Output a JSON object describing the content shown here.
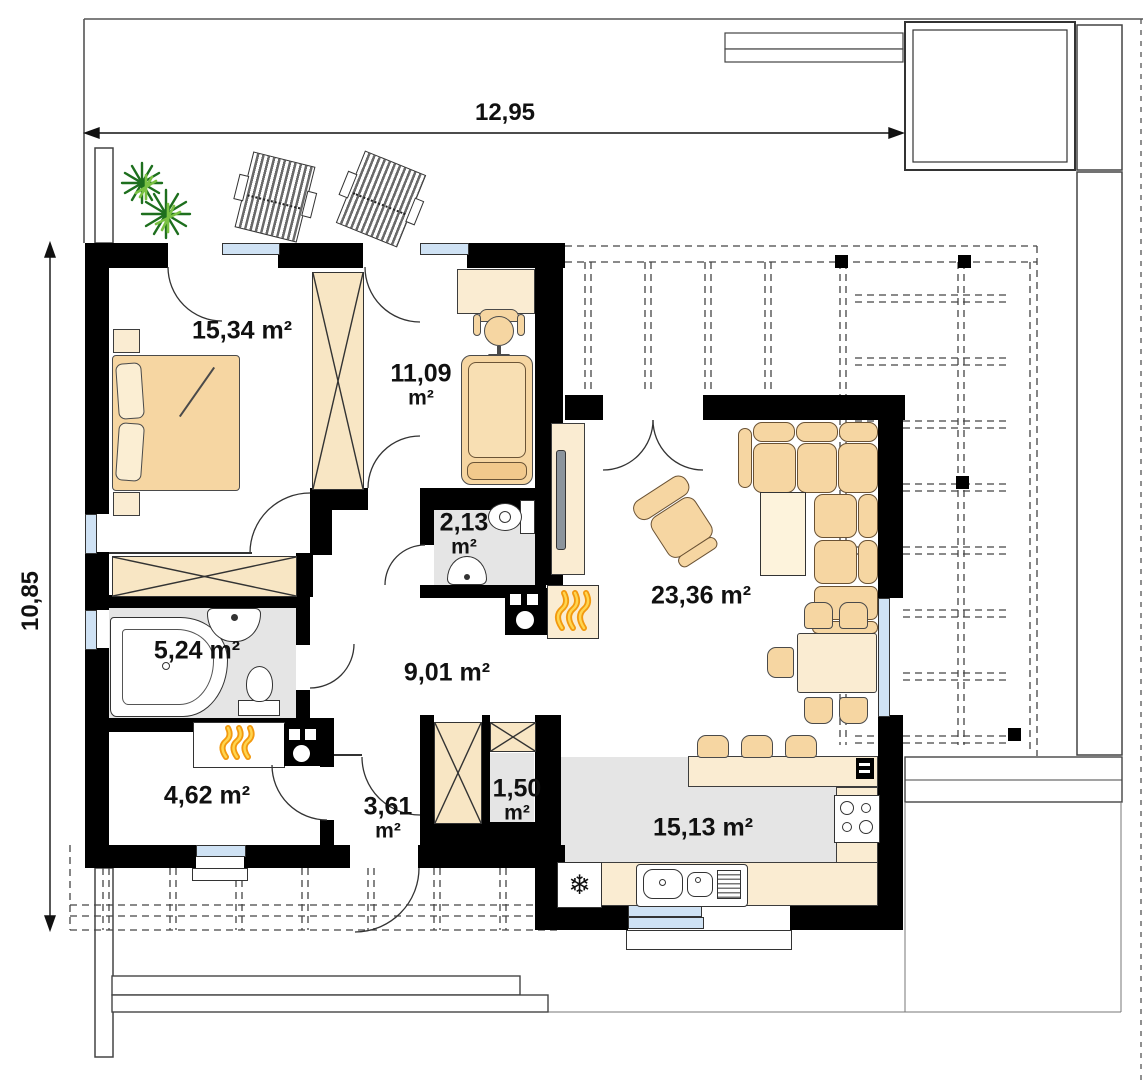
{
  "dimensions": {
    "top": "12,95",
    "left": "10,85"
  },
  "rooms": {
    "bedroom": {
      "area": "15,34 m²"
    },
    "office": {
      "value": "11,09",
      "unit": "m²"
    },
    "wc": {
      "value": "2,13",
      "unit": "m²"
    },
    "bathroom": {
      "area": "5,24 m²"
    },
    "boiler": {
      "area": "4,62 m²"
    },
    "entry": {
      "value": "3,61",
      "unit": "m²"
    },
    "pantry": {
      "value": "1,50",
      "unit": "m²"
    },
    "hall": {
      "area": "9,01 m²"
    },
    "living": {
      "area": "23,36 m²"
    },
    "kitchen": {
      "area": "15,13 m²"
    }
  },
  "icons": {
    "fridge_snowflake": "❄"
  },
  "colors": {
    "wall": "#000000",
    "furniture_tan": "#f6d6a2",
    "furniture_light": "#faecd2",
    "wet_floor": "#e5e5e5",
    "window_blue": "#cfe2f4",
    "flame_orange": "#f2990f",
    "flame_yellow": "#ffd54f",
    "plant_green": "#2e8b2e"
  }
}
